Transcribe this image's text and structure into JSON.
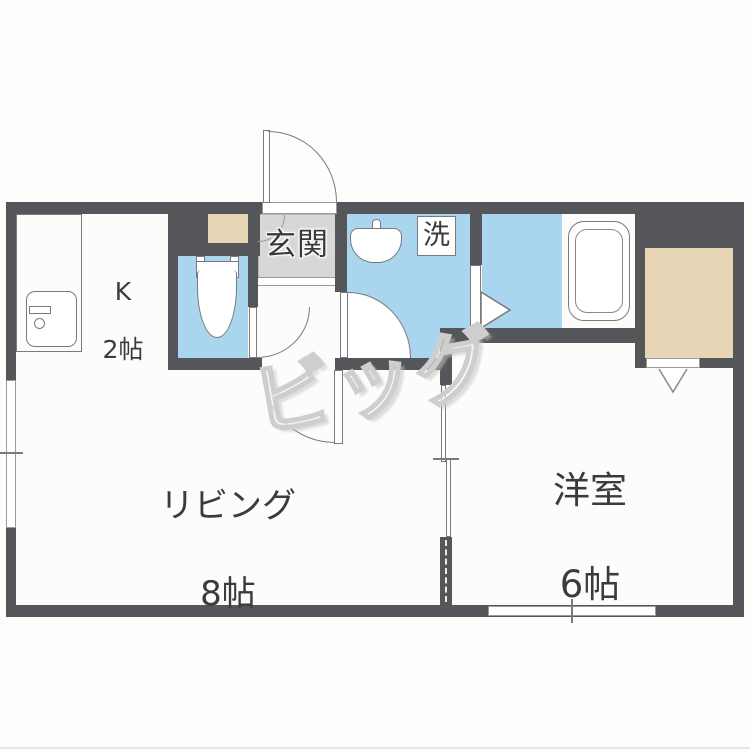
{
  "rooms": {
    "kitchen": {
      "label": "K",
      "size": "2帖"
    },
    "living": {
      "label": "リビング",
      "size": "8帖"
    },
    "western": {
      "label": "洋室",
      "size": "6帖"
    },
    "entrance": {
      "label": "玄関"
    },
    "laundry": {
      "label": "洗"
    }
  },
  "watermark": {
    "text": "ビッグ"
  },
  "colors": {
    "wall": "#545659",
    "water_area_blue": "#a9d5ef",
    "closet_tan": "#e8d5b6",
    "entrance_tile_gray": "#d7d7d5",
    "floor_white": "#fcfcfb",
    "fixture_line": "#7a7a7a",
    "text": "#3b3b3b"
  },
  "icons": [
    "kitchen-sink-icon",
    "toilet-icon",
    "wash-basin-icon",
    "bathtub-icon",
    "shoe-cabinet-icon",
    "closet-icon",
    "door-swing-icon",
    "sliding-door-icon",
    "window-icon",
    "door-direction-arrow-icon"
  ]
}
